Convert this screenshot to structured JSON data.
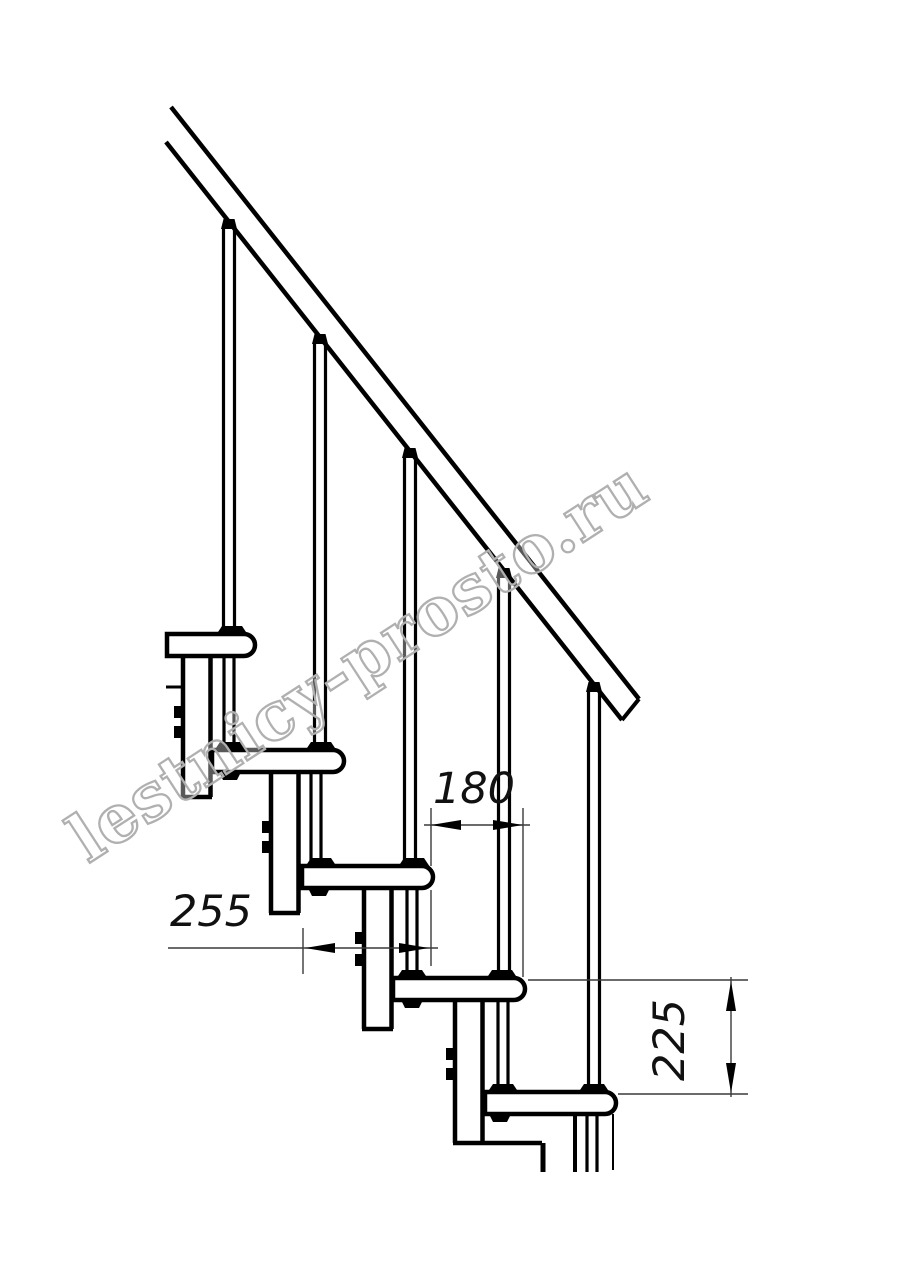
{
  "drawing": {
    "type": "staircase-side-elevation",
    "watermark": "lestnicy-prosto.ru",
    "dimension_labels": {
      "step_run": "180",
      "tread_depth": "255",
      "step_rise": "225"
    },
    "element_counts": {
      "treads": 5,
      "balusters": 5,
      "support_columns": 4
    },
    "colors": {
      "background": "#ffffff",
      "line": "#000000",
      "dimension_line": "#3a3a3a",
      "watermark_outline": "#b0b0b0"
    }
  }
}
